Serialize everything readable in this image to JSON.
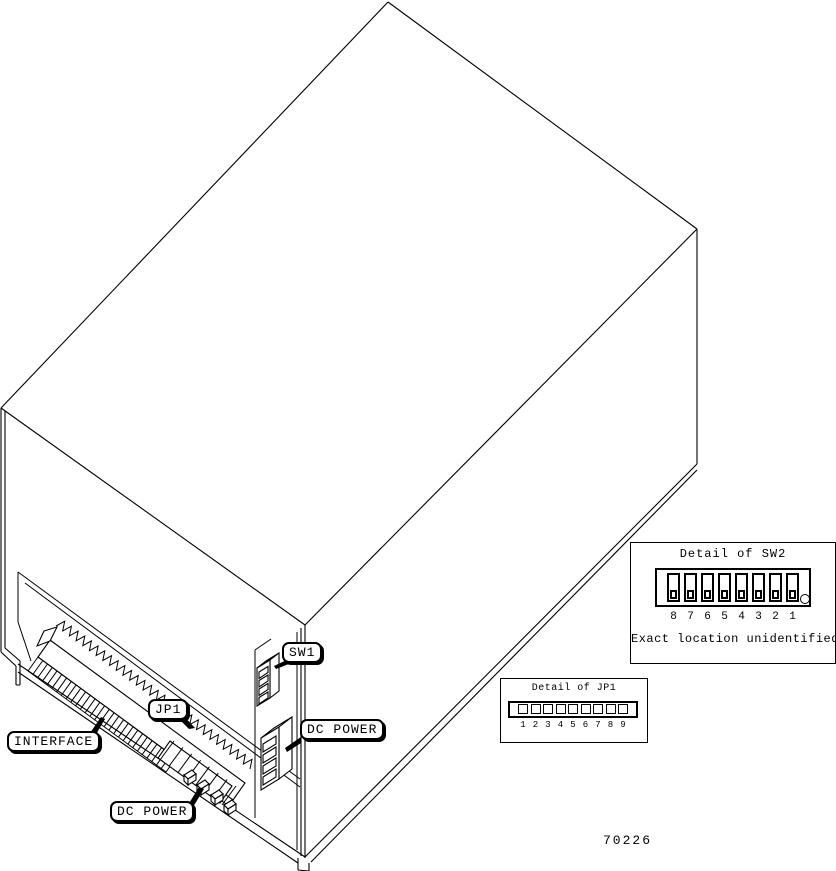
{
  "figure": {
    "number": "70226",
    "background_color": "#ffffff",
    "line_color": "#000000"
  },
  "callouts": {
    "interface": "INTERFACE",
    "jp1": "JP1",
    "sw1": "SW1",
    "dc_power_right": "DC POWER",
    "dc_power_bottom": "DC POWER"
  },
  "detail_sw2": {
    "title": "Detail of SW2",
    "caption": "Exact location unidentified",
    "switch_numbers": [
      "8",
      "7",
      "6",
      "5",
      "4",
      "3",
      "2",
      "1"
    ]
  },
  "detail_jp1": {
    "title": "Detail of JP1",
    "pin_numbers": [
      "1",
      "2",
      "3",
      "4",
      "5",
      "6",
      "7",
      "8",
      "9"
    ]
  }
}
